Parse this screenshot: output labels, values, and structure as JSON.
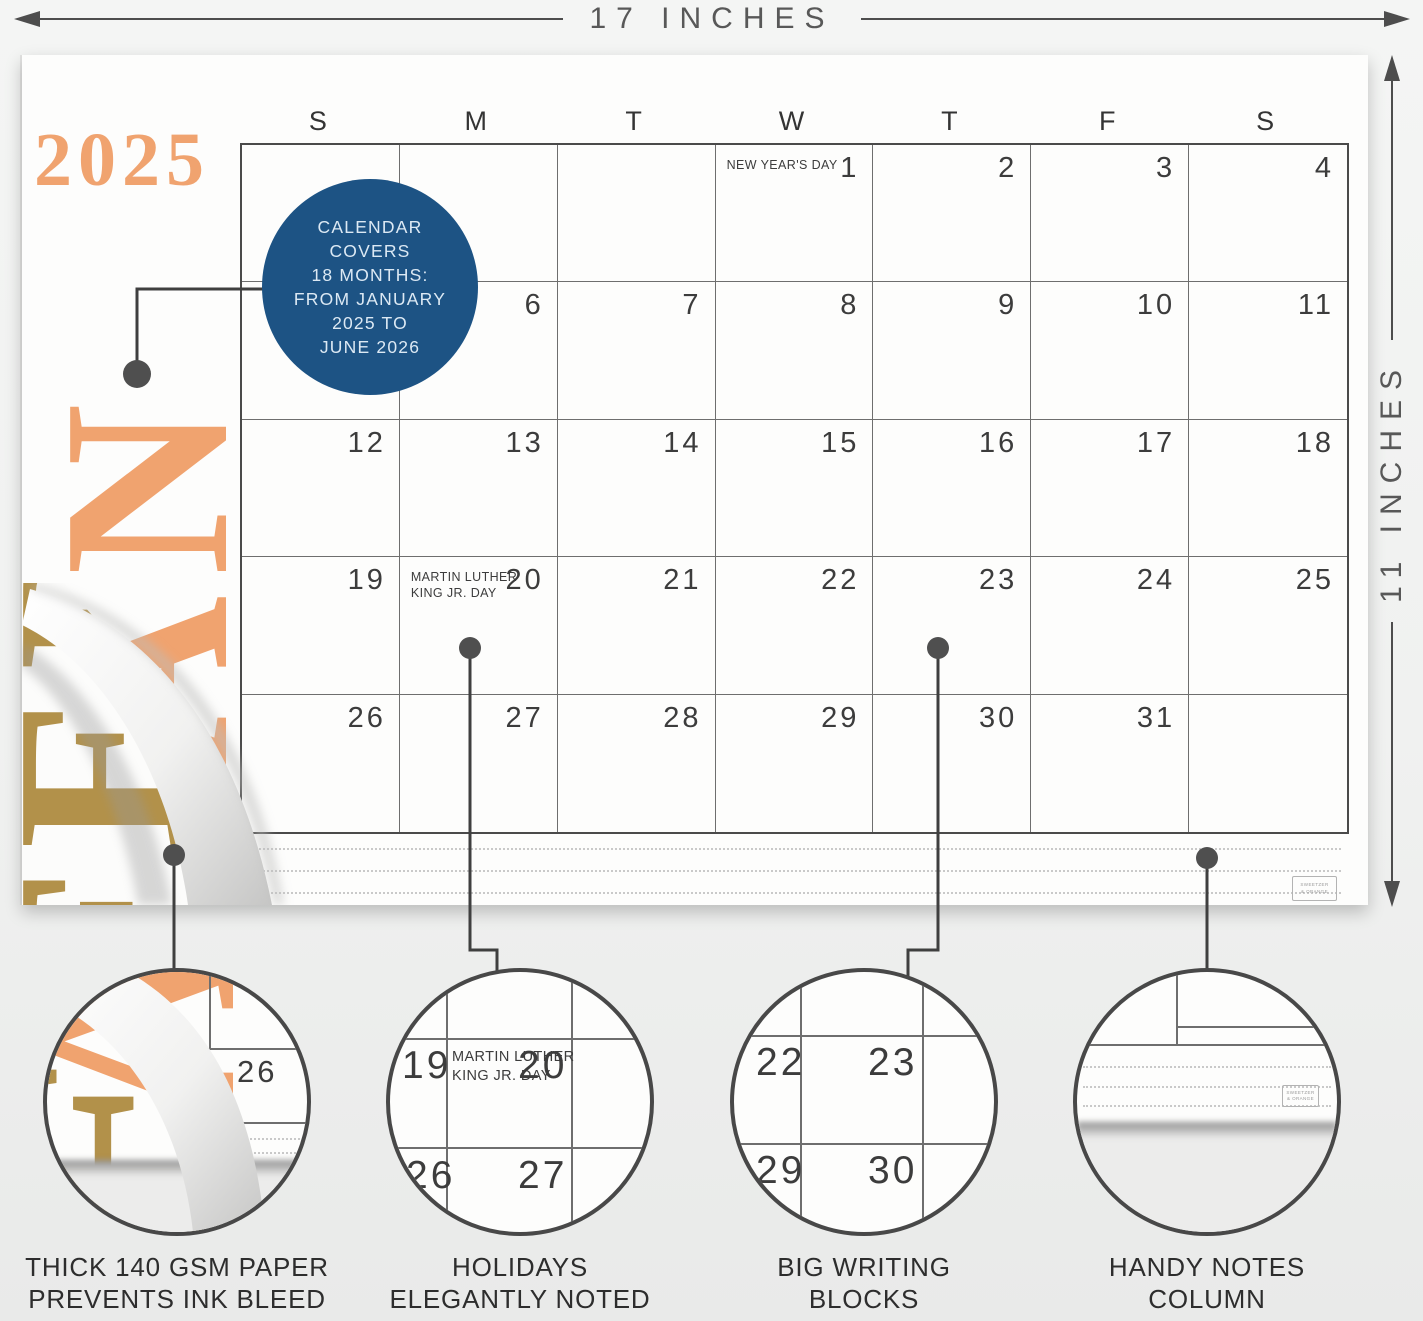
{
  "dimensions": {
    "width": "17 INCHES",
    "height": "11 INCHES"
  },
  "page": {
    "year": "2025",
    "month_label": "JAN",
    "under_page_month_label": "FEB",
    "day_headers": [
      "S",
      "M",
      "T",
      "W",
      "T",
      "F",
      "S"
    ],
    "weeks": [
      [
        {
          "d": ""
        },
        {
          "d": ""
        },
        {
          "d": ""
        },
        {
          "d": "1",
          "h": [
            "NEW YEAR'S DAY"
          ]
        },
        {
          "d": "2"
        },
        {
          "d": "3"
        },
        {
          "d": "4"
        }
      ],
      [
        {
          "d": "5"
        },
        {
          "d": "6"
        },
        {
          "d": "7"
        },
        {
          "d": "8"
        },
        {
          "d": "9"
        },
        {
          "d": "10"
        },
        {
          "d": "11"
        }
      ],
      [
        {
          "d": "12"
        },
        {
          "d": "13"
        },
        {
          "d": "14"
        },
        {
          "d": "15"
        },
        {
          "d": "16"
        },
        {
          "d": "17"
        },
        {
          "d": "18"
        }
      ],
      [
        {
          "d": "19"
        },
        {
          "d": "20",
          "h": [
            "MARTIN LUTHER",
            "KING JR. DAY"
          ]
        },
        {
          "d": "21"
        },
        {
          "d": "22"
        },
        {
          "d": "23"
        },
        {
          "d": "24"
        },
        {
          "d": "25"
        }
      ],
      [
        {
          "d": "26"
        },
        {
          "d": "27"
        },
        {
          "d": "28"
        },
        {
          "d": "29"
        },
        {
          "d": "30"
        },
        {
          "d": "31"
        },
        {
          "d": ""
        }
      ]
    ],
    "brand_mark_lines": [
      "SWEETZER",
      "& ORANGE"
    ]
  },
  "callout": {
    "lines": [
      "CALENDAR",
      "COVERS",
      "18 MONTHS:",
      "FROM JANUARY",
      "2025 TO",
      "JUNE 2026"
    ]
  },
  "insets": [
    {
      "caption": [
        "THICK 140 GSM PAPER",
        "PREVENTS INK BLEED"
      ],
      "visible_date": "26",
      "orange_letter": "A",
      "gold_letter": "E"
    },
    {
      "caption": [
        "HOLIDAYS",
        "ELEGANTLY NOTED"
      ],
      "dates": [
        "19",
        "20",
        "26",
        "27"
      ],
      "holiday_lines": [
        "MARTIN LUTHER",
        "KING JR. DAY"
      ]
    },
    {
      "caption": [
        "BIG WRITING",
        "BLOCKS"
      ],
      "dates": [
        "22",
        "23",
        "29",
        "30"
      ]
    },
    {
      "caption": [
        "HANDY NOTES",
        "COLUMN"
      ],
      "brand_mark_lines": [
        "SWEETZER",
        "& ORANGE"
      ]
    }
  ],
  "colors": {
    "accent_orange": "#f0a36f",
    "accent_gold": "#b2914a",
    "callout_blue": "#1d5384"
  }
}
